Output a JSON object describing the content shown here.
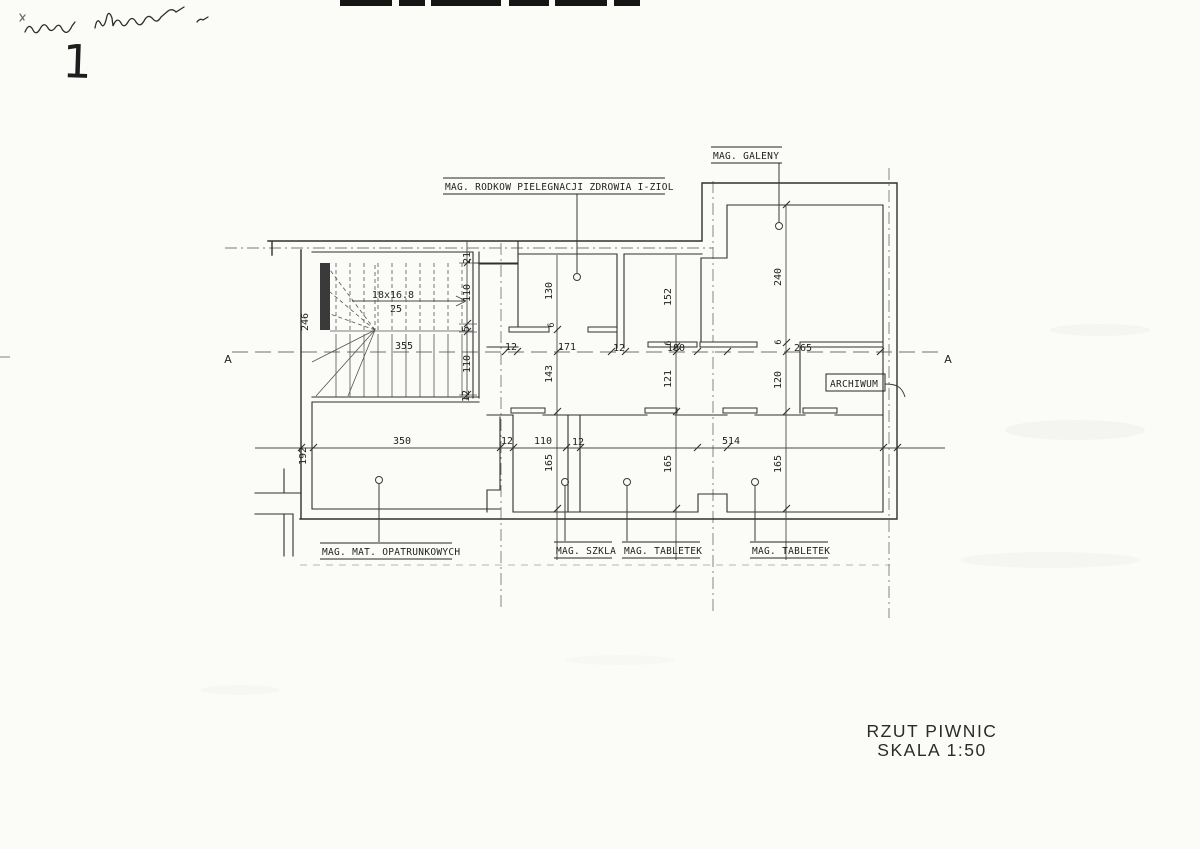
{
  "sheet": {
    "number": "1",
    "title_line1": "RZUT PIWNIC",
    "title_line2": "SKALA 1:50"
  },
  "section_marks": {
    "left": "A",
    "right": "A"
  },
  "labels": {
    "pielegnacji": "MAG. RODKOW PIELEGNACJI ZDROWIA I-ZIOL",
    "galeny": "MAG. GALENY",
    "archiwum": "ARCHIWUM",
    "opatrunkowych": "MAG. MAT. OPATRUNKOWYCH",
    "szkla": "MAG. SZKLA",
    "tabletek1": "MAG. TABLETEK",
    "tabletek2": "MAG. TABLETEK"
  },
  "stairs": {
    "formula_top": "18x16.8",
    "formula_bottom": "25"
  },
  "dims": {
    "d21": "21",
    "d110a": "110",
    "d5": "5",
    "d110b": "110",
    "d12a": "12",
    "d246": "246",
    "d355": "355",
    "d130": "130",
    "d152": "152",
    "d240": "240",
    "d12b": "12",
    "d171": "171",
    "d12c": "12",
    "d180": "180",
    "d265": "265",
    "d143": "143",
    "d121": "121",
    "d120": "120",
    "d6a": "6",
    "d6b": "6",
    "d6c": "6",
    "d350": "350",
    "d192": "192",
    "d12d": "12",
    "d110c": "110",
    "d12e": "12",
    "d514": "514",
    "d165a": "165",
    "d165b": "165",
    "d165c": "165"
  }
}
